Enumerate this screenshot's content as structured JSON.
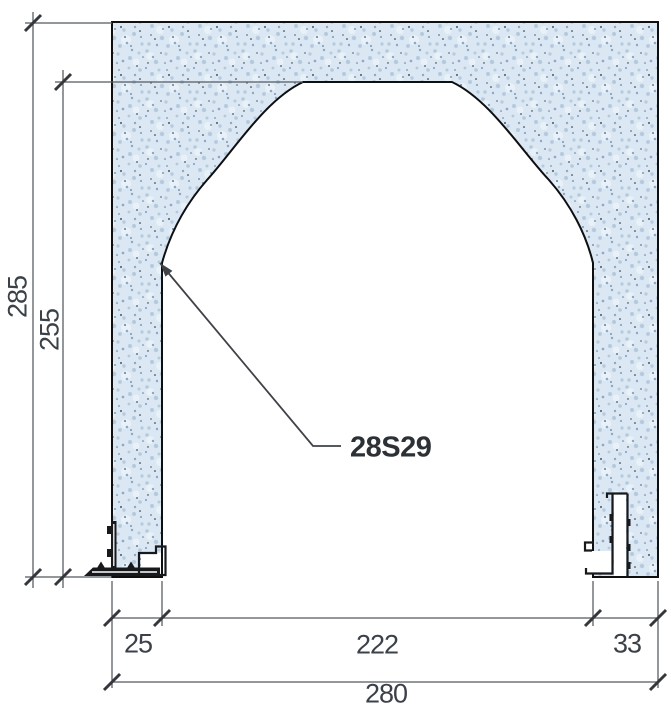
{
  "drawing": {
    "title": "wall-opening-section-detail",
    "leader": {
      "part_code": "28S29"
    },
    "dimensions": {
      "overall_height": "285",
      "opening_height": "255",
      "left_pier_width": "25",
      "opening_width": "222",
      "right_pier_width": "33",
      "overall_width": "280"
    },
    "colors": {
      "wall_fill": "#dbe7f2",
      "speckle_light": "#e9f1f8",
      "speckle_mid": "#b4cade",
      "speckle_deep": "#8aa8c6",
      "speckle_slate": "#5e7c9b",
      "speckle_ink": "#22262a",
      "outline": "#0d0f11",
      "profile": "#17191c",
      "dim_line": "#55595e",
      "tick": "#34383c",
      "dim_text": "#3b4148",
      "label_text": "#2c3136"
    }
  }
}
